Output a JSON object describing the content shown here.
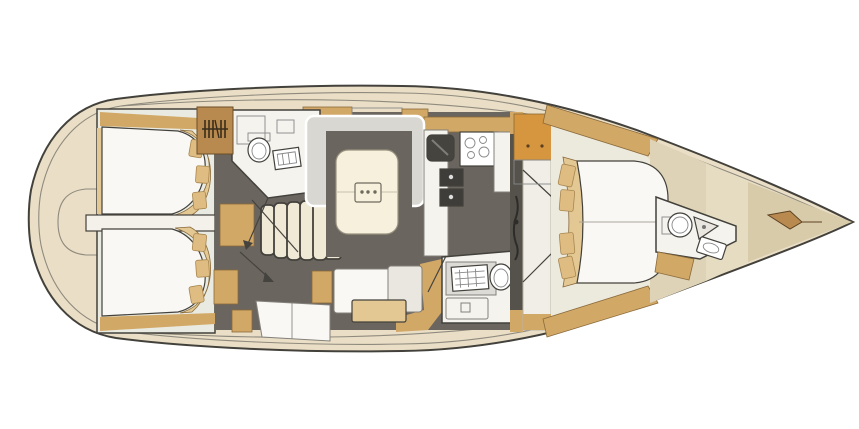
{
  "plan": {
    "kind": "sailing-yacht-interior-layout",
    "view": "top-down",
    "bow_direction": "right",
    "rooms": [
      "aft-cabin-port",
      "aft-cabin-starboard",
      "aft-head-port",
      "companionway",
      "saloon",
      "galley",
      "head-starboard",
      "forward-cabin",
      "forward-head",
      "bow-locker"
    ],
    "fixtures": [
      "double-bed",
      "pillows",
      "hanging-locker",
      "toilet",
      "washbasin",
      "shower-tray",
      "companionway-stairs",
      "saloon-table",
      "u-settee",
      "sofa",
      "chaise",
      "galley-sink",
      "stove-burners",
      "refrigerator",
      "mast",
      "anchor-windlass"
    ]
  },
  "colors": {
    "page_bg": "#ffffff",
    "outline": "#43413b",
    "line_soft": "#8f8a7e",
    "hull_fill": "#eadfc6",
    "stern_gray": "#cdc5b1",
    "cabin_pale": "#e9ebe2",
    "floor_dark": "#6b6560",
    "wood": "#d2a867",
    "wood_light": "#e3c894",
    "wood_dark": "#b98a50",
    "orange": "#d6953f",
    "white_room": "#f4f3ee",
    "bed_white": "#f9f8f4",
    "pillow": "#dfbc82",
    "settee_gray": "#d8d7d2",
    "table_cream": "#f7f0dc",
    "steps_cream": "#efe9d6",
    "sink_dark": "#45443f",
    "fridge_dark": "#3e3d39",
    "counter_gray": "#dddbd5",
    "cushion_gray": "#e9e7e0",
    "corridor_white": "#f0eee7",
    "bulkhead_dark": "#55524c",
    "panel_a": "#ded3b6",
    "panel_b": "#e6dcc2",
    "panel_c": "#d8cbaa",
    "pale_floor": "#ece9dd",
    "divider_white": "#f3f1ea",
    "fixture_white": "#ffffff",
    "arrow": "#45433d"
  }
}
